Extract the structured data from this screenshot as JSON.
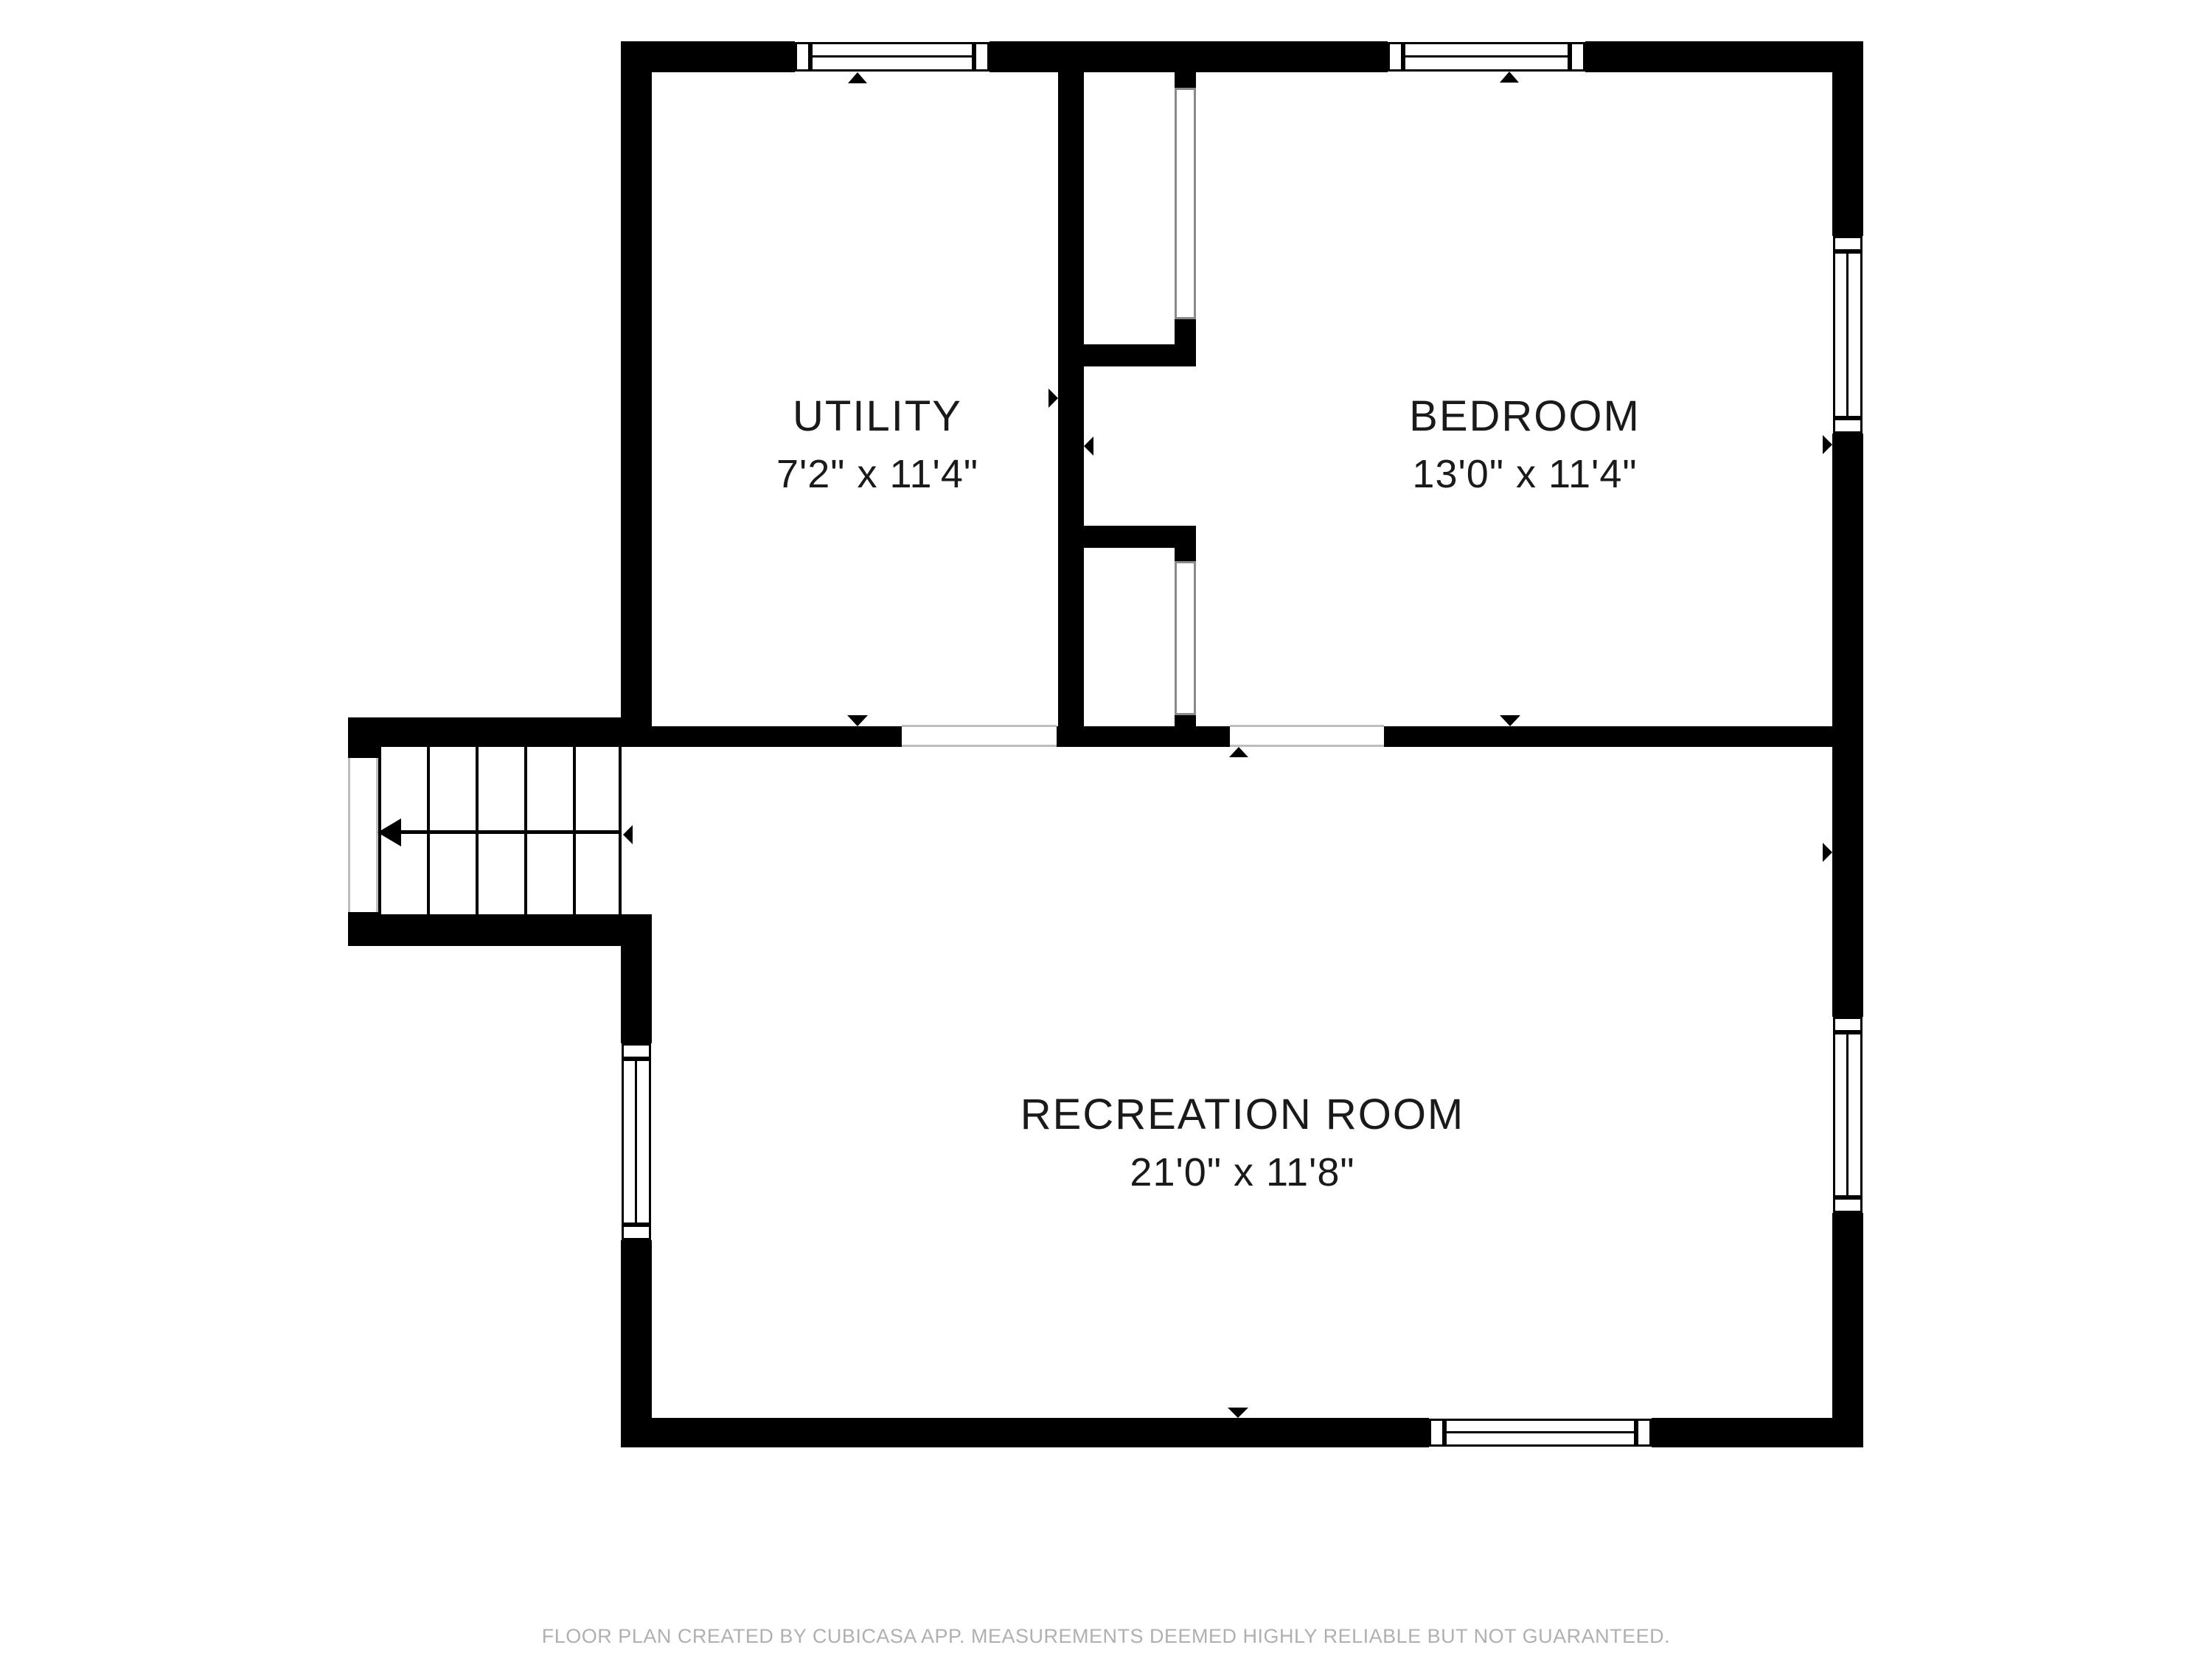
{
  "title": "Floor plan",
  "rooms": [
    {
      "id": "utility",
      "name": "UTILITY",
      "dimensions": "7'2\" x 11'4\""
    },
    {
      "id": "bedroom",
      "name": "BEDROOM",
      "dimensions": "13'0\" x 11'4\""
    },
    {
      "id": "recreation",
      "name": "RECREATION ROOM",
      "dimensions": "21'0\" x 11'8\""
    }
  ],
  "stairs": {
    "treads": 5,
    "direction": "left"
  },
  "windows_count": 6,
  "footer": {
    "text": "FLOOR PLAN CREATED BY CUBICASA APP. MEASUREMENTS DEEMED HIGHLY RELIABLE BUT NOT GUARANTEED."
  },
  "colors": {
    "wall": "#000000",
    "background": "#ffffff",
    "frame": "#000000",
    "opening_line": "#bdbdbd",
    "footer_text": "#b0b0b0",
    "label_text": "#1a1a1a"
  }
}
